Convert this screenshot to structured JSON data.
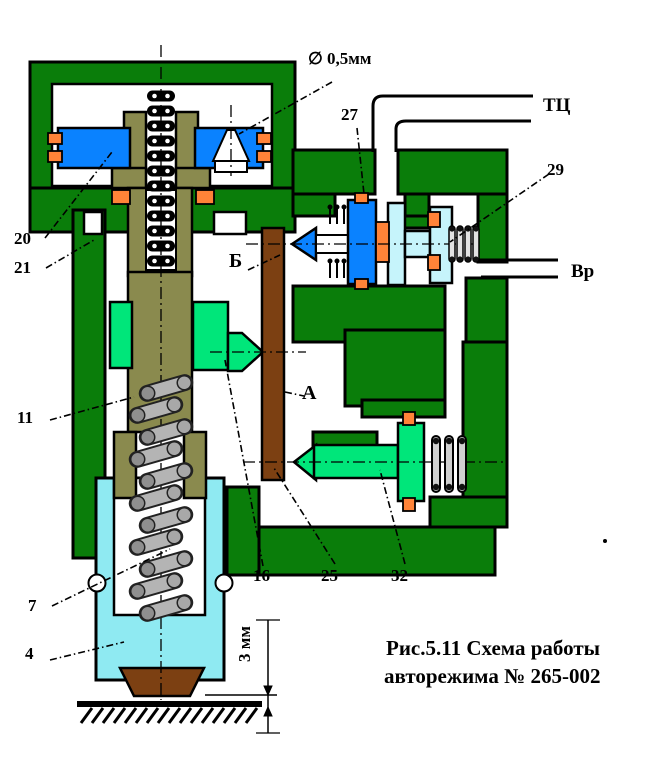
{
  "colors": {
    "housing": "#0a7d0a",
    "olive": "#8a8a4e",
    "blue": "#0a82ff",
    "cyan_cylinder": "#8feaf2",
    "cyan_piston": "#c6f4fb",
    "bright_green": "#00e67a",
    "orange": "#ff8338",
    "brown": "#7c4012",
    "spring_gray": "#b4b4b4"
  },
  "labels": {
    "p20": "20",
    "p21": "21",
    "p11": "11",
    "p7": "7",
    "p4": "4",
    "p16": "16",
    "p25": "25",
    "p27": "27",
    "p29": "29",
    "p32": "32",
    "chamber_a": "А",
    "chamber_b": "Б",
    "orifice": "∅ 0,5мм",
    "pipe_tc": "ТЦ",
    "pipe_vr": "Вр",
    "gap": "3 мм"
  },
  "caption": {
    "line1": "Рис.5.11 Схема работы",
    "line2": "авторежима № 265-002"
  }
}
